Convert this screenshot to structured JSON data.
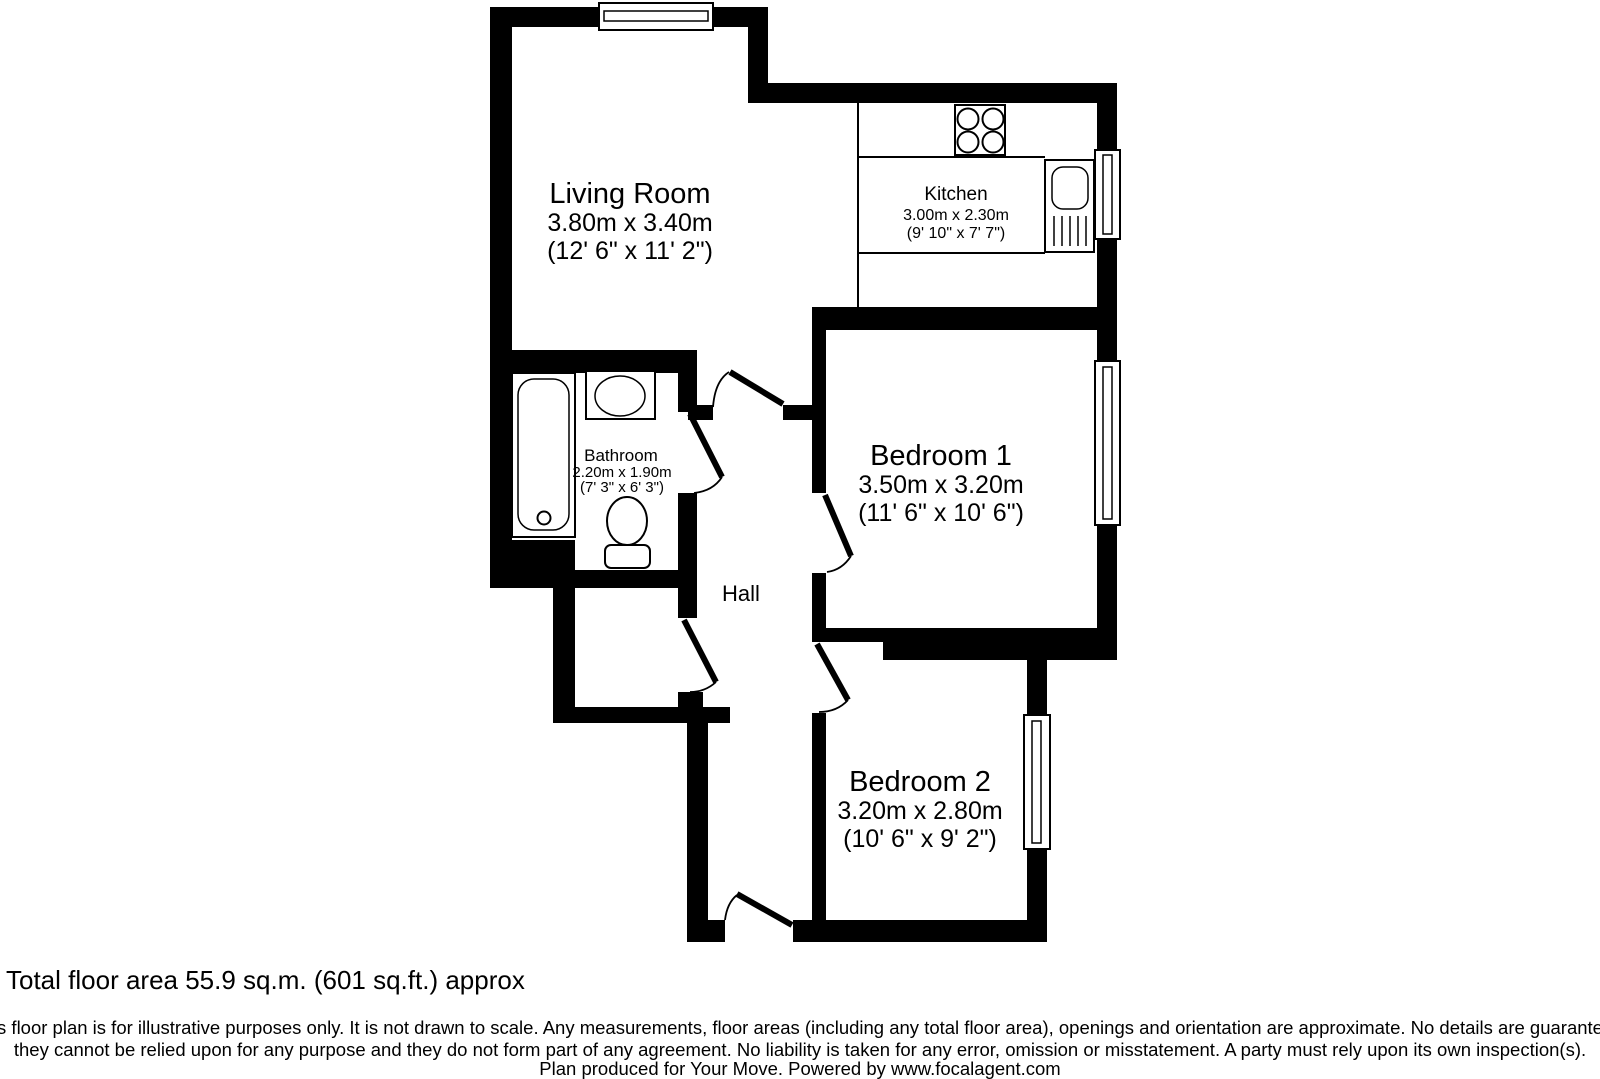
{
  "plan": {
    "rooms": {
      "living_room": {
        "name": "Living Room",
        "dims_metric": "3.80m x 3.40m",
        "dims_imperial": "(12' 6\" x 11' 2\")"
      },
      "kitchen": {
        "name": "Kitchen",
        "dims_metric": "3.00m x 2.30m",
        "dims_imperial": "(9' 10\" x 7' 7\")"
      },
      "bathroom": {
        "name": "Bathroom",
        "dims_metric": "2.20m x 1.90m",
        "dims_imperial": "(7' 3\" x 6' 3\")"
      },
      "bedroom_1": {
        "name": "Bedroom 1",
        "dims_metric": "3.50m x 3.20m",
        "dims_imperial": "(11' 6\" x 10' 6\")"
      },
      "bedroom_2": {
        "name": "Bedroom 2",
        "dims_metric": "3.20m x 2.80m",
        "dims_imperial": "(10' 6\" x 9' 2\")"
      },
      "hall": {
        "name": "Hall"
      }
    },
    "footer": {
      "total_area": "Total floor area 55.9 sq.m. (601 sq.ft.) approx",
      "disclaimer_line1": "This floor plan is for illustrative purposes only. It is not drawn to scale. Any measurements, floor areas (including any total floor area), openings and orientation are approximate. No details are guaranteed,",
      "disclaimer_line2": "they cannot be relied upon for any purpose and they do not form part of any agreement. No liability is taken for any error, omission or misstatement. A party must rely upon its own inspection(s).",
      "disclaimer_line3": "Plan produced for Your Move. Powered by www.focalagent.com"
    },
    "colors": {
      "wall": "#000000",
      "background": "#ffffff"
    }
  }
}
